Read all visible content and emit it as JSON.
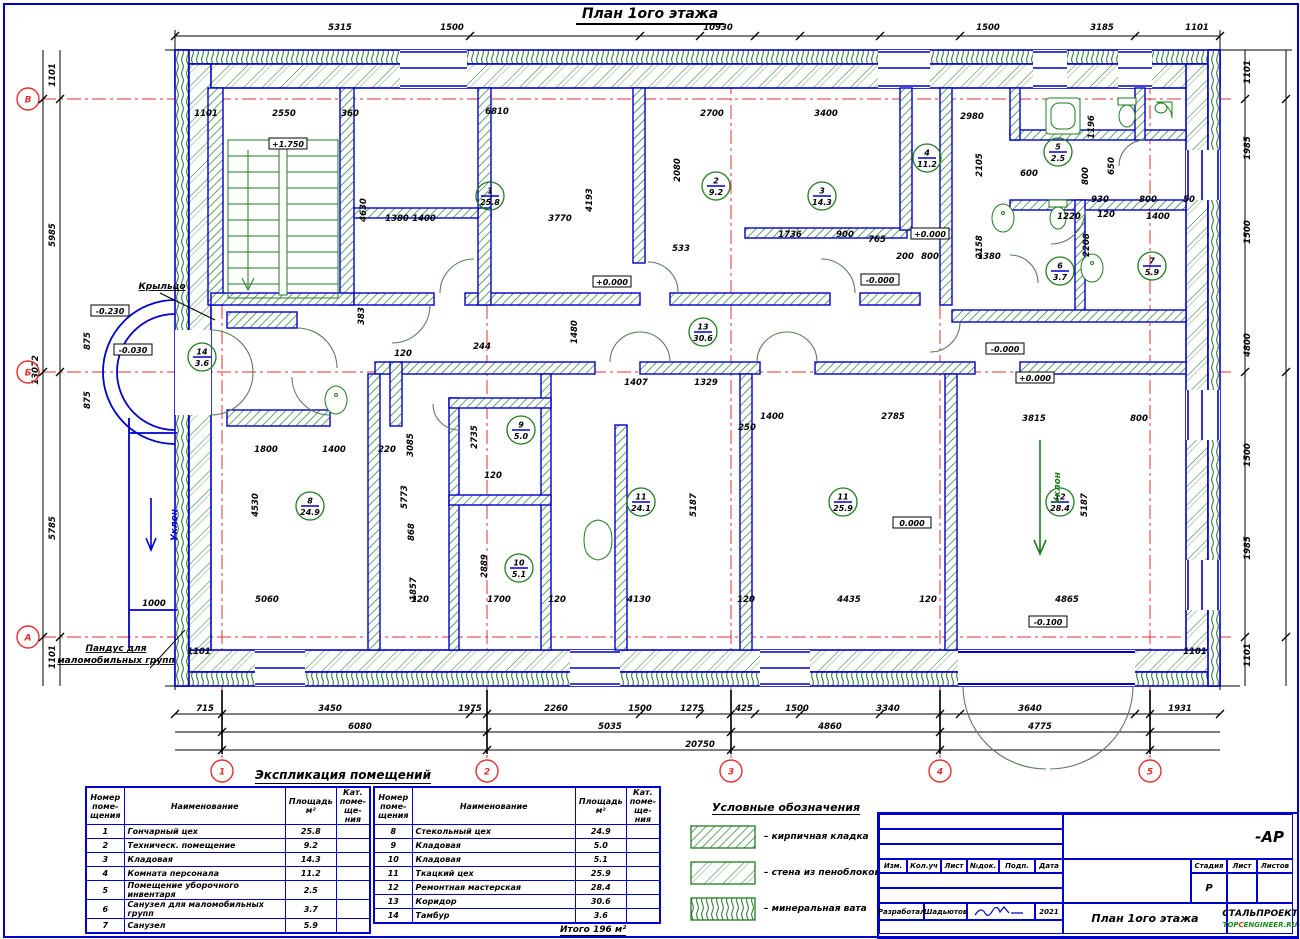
{
  "title": "План 1ого этажа",
  "colors": {
    "wall_blue": "#0000cc",
    "hatch_green": "#1e7d1e",
    "axis_red": "#e23030",
    "dim_black": "#000000"
  },
  "plan": {
    "axes_bottom": [
      {
        "label": "1",
        "x": 222
      },
      {
        "label": "2",
        "x": 487
      },
      {
        "label": "3",
        "x": 731
      },
      {
        "label": "4",
        "x": 940
      },
      {
        "label": "5",
        "x": 1150
      }
    ],
    "axes_left": [
      {
        "label": "В",
        "y": 99
      },
      {
        "label": "Б",
        "y": 372
      },
      {
        "label": "А",
        "y": 637
      }
    ],
    "dims": [
      {
        "t": "5315",
        "x": 340,
        "y": 30
      },
      {
        "t": "1500",
        "x": 452,
        "y": 30
      },
      {
        "t": "10930",
        "x": 718,
        "y": 30
      },
      {
        "t": "1500",
        "x": 988,
        "y": 30
      },
      {
        "t": "3185",
        "x": 1102,
        "y": 30
      },
      {
        "t": "1101",
        "x": 1197,
        "y": 30
      },
      {
        "t": "715",
        "x": 205,
        "y": 711
      },
      {
        "t": "3450",
        "x": 330,
        "y": 711
      },
      {
        "t": "1975",
        "x": 470,
        "y": 711
      },
      {
        "t": "2260",
        "x": 556,
        "y": 711
      },
      {
        "t": "1500",
        "x": 640,
        "y": 711
      },
      {
        "t": "1275",
        "x": 692,
        "y": 711
      },
      {
        "t": "425",
        "x": 744,
        "y": 711
      },
      {
        "t": "1500",
        "x": 797,
        "y": 711
      },
      {
        "t": "3340",
        "x": 888,
        "y": 711
      },
      {
        "t": "3640",
        "x": 1030,
        "y": 711
      },
      {
        "t": "1931",
        "x": 1180,
        "y": 711
      },
      {
        "t": "6080",
        "x": 360,
        "y": 729
      },
      {
        "t": "5035",
        "x": 610,
        "y": 729
      },
      {
        "t": "4860",
        "x": 830,
        "y": 729
      },
      {
        "t": "4775",
        "x": 1040,
        "y": 729
      },
      {
        "t": "20750",
        "x": 700,
        "y": 747
      },
      {
        "t": "1101",
        "x": 55,
        "y": 75,
        "r": -90
      },
      {
        "t": "5985",
        "x": 55,
        "y": 235,
        "r": -90
      },
      {
        "t": "875",
        "x": 90,
        "y": 341,
        "r": -90
      },
      {
        "t": "875",
        "x": 90,
        "y": 400,
        "r": -90
      },
      {
        "t": "5785",
        "x": 55,
        "y": 528,
        "r": -90
      },
      {
        "t": "1101",
        "x": 55,
        "y": 657,
        "r": -90
      },
      {
        "t": "13072",
        "x": 38,
        "y": 370,
        "r": -90
      },
      {
        "t": "1101",
        "x": 1250,
        "y": 72,
        "r": -90
      },
      {
        "t": "1985",
        "x": 1250,
        "y": 148,
        "r": -90
      },
      {
        "t": "1500",
        "x": 1250,
        "y": 232,
        "r": -90
      },
      {
        "t": "4800",
        "x": 1250,
        "y": 345,
        "r": -90
      },
      {
        "t": "1500",
        "x": 1250,
        "y": 455,
        "r": -90
      },
      {
        "t": "1985",
        "x": 1250,
        "y": 548,
        "r": -90
      },
      {
        "t": "1101",
        "x": 1250,
        "y": 655,
        "r": -90
      },
      {
        "t": "1101",
        "x": 206,
        "y": 116
      },
      {
        "t": "2550",
        "x": 284,
        "y": 116
      },
      {
        "t": "360",
        "x": 350,
        "y": 116
      },
      {
        "t": "6810",
        "x": 497,
        "y": 114
      },
      {
        "t": "2700",
        "x": 712,
        "y": 116
      },
      {
        "t": "3400",
        "x": 826,
        "y": 116
      },
      {
        "t": "2980",
        "x": 972,
        "y": 119
      },
      {
        "t": "4630",
        "x": 366,
        "y": 210,
        "r": -90
      },
      {
        "t": "1380",
        "x": 397,
        "y": 221
      },
      {
        "t": "1400",
        "x": 424,
        "y": 221
      },
      {
        "t": "3770",
        "x": 560,
        "y": 221
      },
      {
        "t": "4193",
        "x": 592,
        "y": 200,
        "r": -90
      },
      {
        "t": "2080",
        "x": 680,
        "y": 170,
        "r": -90
      },
      {
        "t": "1196",
        "x": 1094,
        "y": 127,
        "r": -90
      },
      {
        "t": "600",
        "x": 1029,
        "y": 176
      },
      {
        "t": "650",
        "x": 1114,
        "y": 166,
        "r": -90
      },
      {
        "t": "800",
        "x": 1088,
        "y": 176,
        "r": -90
      },
      {
        "t": "2105",
        "x": 982,
        "y": 165,
        "r": -90
      },
      {
        "t": "2158",
        "x": 982,
        "y": 247,
        "r": -90
      },
      {
        "t": "1736",
        "x": 790,
        "y": 237
      },
      {
        "t": "900",
        "x": 845,
        "y": 237
      },
      {
        "t": "765",
        "x": 877,
        "y": 242
      },
      {
        "t": "533",
        "x": 681,
        "y": 251
      },
      {
        "t": "930",
        "x": 1100,
        "y": 202
      },
      {
        "t": "800",
        "x": 1148,
        "y": 202
      },
      {
        "t": "50",
        "x": 1189,
        "y": 202
      },
      {
        "t": "120",
        "x": 1106,
        "y": 217
      },
      {
        "t": "1400",
        "x": 1158,
        "y": 219
      },
      {
        "t": "1220",
        "x": 1069,
        "y": 219
      },
      {
        "t": "2208",
        "x": 1089,
        "y": 245,
        "r": -90
      },
      {
        "t": "1380",
        "x": 989,
        "y": 259
      },
      {
        "t": "800",
        "x": 930,
        "y": 259
      },
      {
        "t": "200",
        "x": 905,
        "y": 259
      },
      {
        "t": "383",
        "x": 364,
        "y": 316,
        "r": -90
      },
      {
        "t": "1480",
        "x": 577,
        "y": 332,
        "r": -90
      },
      {
        "t": "244",
        "x": 482,
        "y": 349
      },
      {
        "t": "120",
        "x": 403,
        "y": 356
      },
      {
        "t": "1407",
        "x": 636,
        "y": 385
      },
      {
        "t": "1329",
        "x": 706,
        "y": 385
      },
      {
        "t": "1400",
        "x": 772,
        "y": 419
      },
      {
        "t": "2785",
        "x": 893,
        "y": 419
      },
      {
        "t": "250",
        "x": 747,
        "y": 430
      },
      {
        "t": "3815",
        "x": 1034,
        "y": 421
      },
      {
        "t": "800",
        "x": 1139,
        "y": 421
      },
      {
        "t": "5187",
        "x": 696,
        "y": 505,
        "r": -90
      },
      {
        "t": "5187",
        "x": 1087,
        "y": 505,
        "r": -90
      },
      {
        "t": "3085",
        "x": 413,
        "y": 445,
        "r": -90
      },
      {
        "t": "2735",
        "x": 477,
        "y": 437,
        "r": -90
      },
      {
        "t": "1800",
        "x": 266,
        "y": 452
      },
      {
        "t": "1400",
        "x": 334,
        "y": 452
      },
      {
        "t": "220",
        "x": 387,
        "y": 452
      },
      {
        "t": "5773",
        "x": 407,
        "y": 497,
        "r": -90
      },
      {
        "t": "868",
        "x": 414,
        "y": 532,
        "r": -90
      },
      {
        "t": "2889",
        "x": 487,
        "y": 566,
        "r": -90
      },
      {
        "t": "120",
        "x": 493,
        "y": 478
      },
      {
        "t": "4530",
        "x": 258,
        "y": 505,
        "r": -90
      },
      {
        "t": "1857",
        "x": 416,
        "y": 589,
        "r": -90
      },
      {
        "t": "1000",
        "x": 154,
        "y": 606
      },
      {
        "t": "5060",
        "x": 267,
        "y": 602
      },
      {
        "t": "120",
        "x": 420,
        "y": 602
      },
      {
        "t": "1700",
        "x": 499,
        "y": 602
      },
      {
        "t": "120",
        "x": 557,
        "y": 602
      },
      {
        "t": "4130",
        "x": 639,
        "y": 602
      },
      {
        "t": "120",
        "x": 746,
        "y": 602
      },
      {
        "t": "4435",
        "x": 849,
        "y": 602
      },
      {
        "t": "120",
        "x": 928,
        "y": 602
      },
      {
        "t": "4865",
        "x": 1067,
        "y": 602
      },
      {
        "t": "1101",
        "x": 199,
        "y": 654
      },
      {
        "t": "1101",
        "x": 1195,
        "y": 654
      }
    ],
    "rooms": [
      {
        "n": "1",
        "a": "25.8",
        "x": 490,
        "y": 196
      },
      {
        "n": "2",
        "a": "9.2",
        "x": 716,
        "y": 186
      },
      {
        "n": "3",
        "a": "14.3",
        "x": 822,
        "y": 196
      },
      {
        "n": "4",
        "a": "11.2",
        "x": 927,
        "y": 158
      },
      {
        "n": "5",
        "a": "2.5",
        "x": 1058,
        "y": 152
      },
      {
        "n": "6",
        "a": "3.7",
        "x": 1060,
        "y": 271
      },
      {
        "n": "7",
        "a": "5.9",
        "x": 1152,
        "y": 266
      },
      {
        "n": "8",
        "a": "24.9",
        "x": 310,
        "y": 506
      },
      {
        "n": "9",
        "a": "5.0",
        "x": 521,
        "y": 430
      },
      {
        "n": "10",
        "a": "5.1",
        "x": 519,
        "y": 568
      },
      {
        "n": "11",
        "a": "24.1",
        "x": 641,
        "y": 502
      },
      {
        "n": "11",
        "a": "25.9",
        "x": 843,
        "y": 502
      },
      {
        "n": "12",
        "a": "28.4",
        "x": 1060,
        "y": 502
      },
      {
        "n": "13",
        "a": "30.6",
        "x": 703,
        "y": 332
      },
      {
        "n": "14",
        "a": "3.6",
        "x": 202,
        "y": 357
      }
    ],
    "levels": [
      {
        "t": "+1.750",
        "x": 288,
        "y": 146
      },
      {
        "t": "-0.230",
        "x": 110,
        "y": 313
      },
      {
        "t": "-0.030",
        "x": 133,
        "y": 352
      },
      {
        "t": "+0.000",
        "x": 612,
        "y": 284
      },
      {
        "t": "-0.000",
        "x": 880,
        "y": 282
      },
      {
        "t": "+0.000",
        "x": 930,
        "y": 236
      },
      {
        "t": "-0.000",
        "x": 1005,
        "y": 351
      },
      {
        "t": "+0.000",
        "x": 1035,
        "y": 380
      },
      {
        "t": "0.000",
        "x": 912,
        "y": 525
      },
      {
        "t": "-0.100",
        "x": 1048,
        "y": 624
      }
    ],
    "notes": [
      {
        "t": "Крыльцо",
        "x": 128,
        "y": 289,
        "c": "#000",
        "u": true
      },
      {
        "t": "Уклон",
        "x": 143,
        "y": 525,
        "r": -90,
        "c": "#0000cc"
      },
      {
        "t": "Уклон",
        "x": 1026,
        "y": 488,
        "r": -90,
        "c": "#1e7d1e"
      },
      {
        "t": "Пандус для",
        "x": 82,
        "y": 651,
        "c": "#000",
        "u": true
      },
      {
        "t": "маломобильных групп",
        "x": 82,
        "y": 663,
        "c": "#000",
        "u": true
      }
    ]
  },
  "explication": {
    "title": "Экспликация помещений",
    "headers": {
      "num": "Номер\nпоме-\nщения",
      "name": "Наименование",
      "area": "Площадь\nм²",
      "cat": "Кат.\nпоме-\nще-\nния"
    },
    "table1": [
      [
        "1",
        "Гончарный цех",
        "25.8"
      ],
      [
        "2",
        "Техническ. помещение",
        "9.2"
      ],
      [
        "3",
        "Кладовая",
        "14.3"
      ],
      [
        "4",
        "Комната персонала",
        "11.2"
      ],
      [
        "5",
        "Помещение уборочного инвентаря",
        "2.5"
      ],
      [
        "6",
        "Санузел для маломобильных групп",
        "3.7"
      ],
      [
        "7",
        "Санузел",
        "5.9"
      ]
    ],
    "table2": [
      [
        "8",
        "Стекольный цех",
        "24.9"
      ],
      [
        "9",
        "Кладовая",
        "5.0"
      ],
      [
        "10",
        "Кладовая",
        "5.1"
      ],
      [
        "11",
        "Ткацкий цех",
        "25.9"
      ],
      [
        "12",
        "Ремонтная мастерская",
        "28.4"
      ],
      [
        "13",
        "Коридор",
        "30.6"
      ],
      [
        "14",
        "Тамбур",
        "3.6"
      ]
    ],
    "total": "Итого    196  м²"
  },
  "legend": {
    "title": "Условные обозначения",
    "items": [
      {
        "label": "– кирпичная кладка",
        "pattern": "brick"
      },
      {
        "label": "– стена из пеноблоков",
        "pattern": "foam"
      },
      {
        "label": "– минеральная вата",
        "pattern": "wool"
      }
    ]
  },
  "titleblock": {
    "code": "-АР",
    "columns": [
      "Изм.",
      "Кол.уч",
      "Лист",
      "№док.",
      "Подп.",
      "Дата"
    ],
    "developed_label": "Разработал",
    "developed_name": "Шадьютов",
    "date": "2021",
    "stage_label": "Стадия",
    "sheet_label": "Лист",
    "sheets_label": "Листов",
    "stage": "Р",
    "drawing_name": "План 1ого этажа",
    "company": "СТАЛЬПРОЕКТ",
    "logo": {
      "part1": "ТОР",
      "part2": "C",
      "part3": "ENGINEER.RU"
    }
  }
}
